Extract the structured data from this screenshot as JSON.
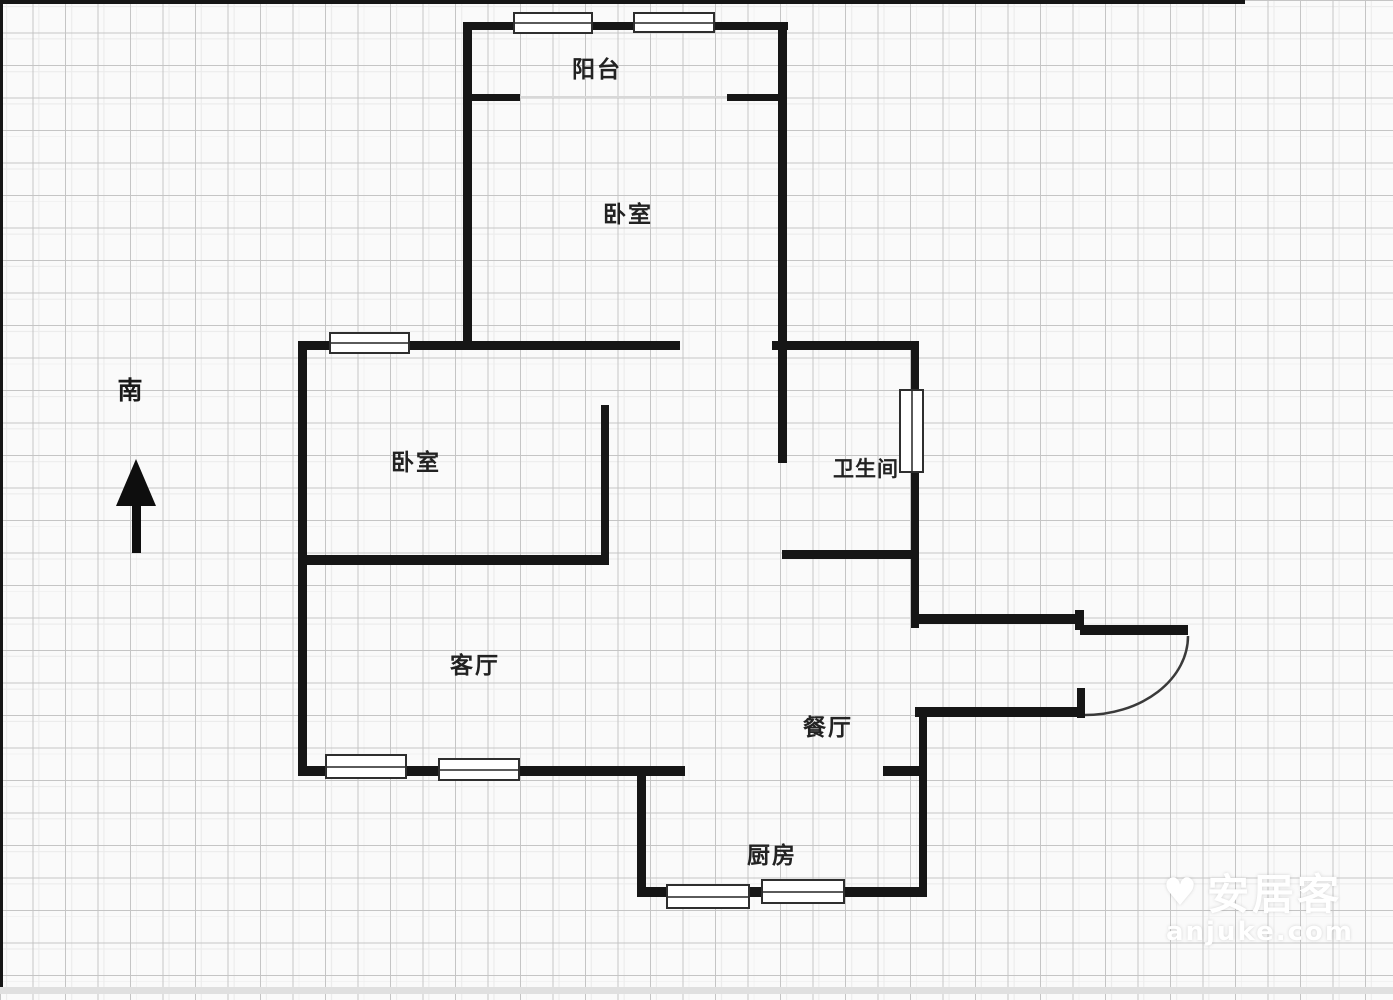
{
  "plan": {
    "rooms": [
      {
        "id": "balcony",
        "label": "阳台"
      },
      {
        "id": "bedroom-top",
        "label": "卧室"
      },
      {
        "id": "bedroom-left",
        "label": "卧室"
      },
      {
        "id": "bathroom",
        "label": "卫生间"
      },
      {
        "id": "living-room",
        "label": "客厅"
      },
      {
        "id": "dining-room",
        "label": "餐厅"
      },
      {
        "id": "kitchen",
        "label": "厨房"
      }
    ]
  },
  "compass": {
    "label": "南",
    "icon": "up-arrow-icon"
  },
  "watermark": {
    "brand": "安居客",
    "domain": "anjuke.com",
    "icon": "heart-logo-icon"
  },
  "colors": {
    "wall": "#161616",
    "grid_line": "#c5c5c5",
    "background": "#fafafa",
    "window_fill": "#ffffff",
    "label_text": "#222222",
    "watermark": "#ffffff"
  }
}
